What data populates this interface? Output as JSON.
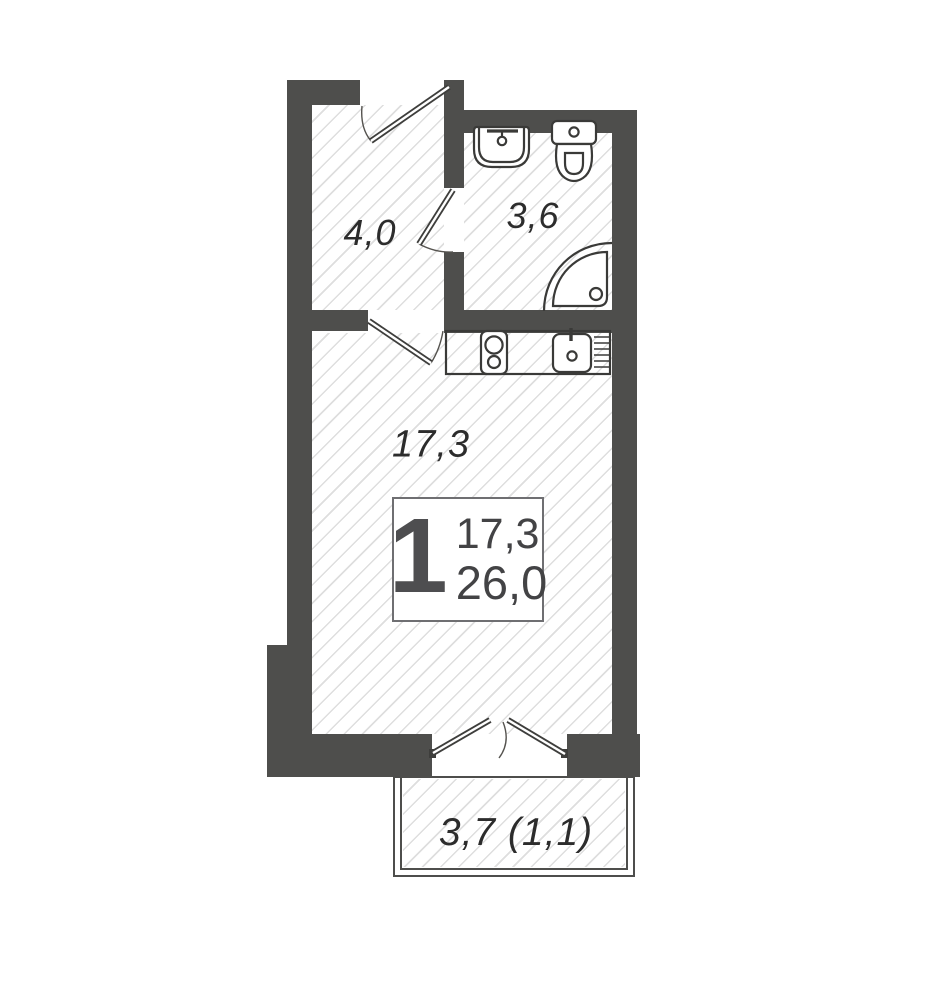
{
  "plan": {
    "title": "studio-apartment-floor-plan",
    "rooms": {
      "hallway": {
        "area": "4,0"
      },
      "bathroom": {
        "area": "3,6"
      },
      "living": {
        "area": "17,3"
      },
      "balcony": {
        "area": "3,7 (1,1)"
      }
    },
    "info_box": {
      "rooms_count": "1",
      "living_area": "17,3",
      "total_area": "26,0"
    },
    "colors": {
      "wall": "#4e4e4c",
      "hatch": "#dedede",
      "fixture_line": "#3a3a38"
    }
  }
}
